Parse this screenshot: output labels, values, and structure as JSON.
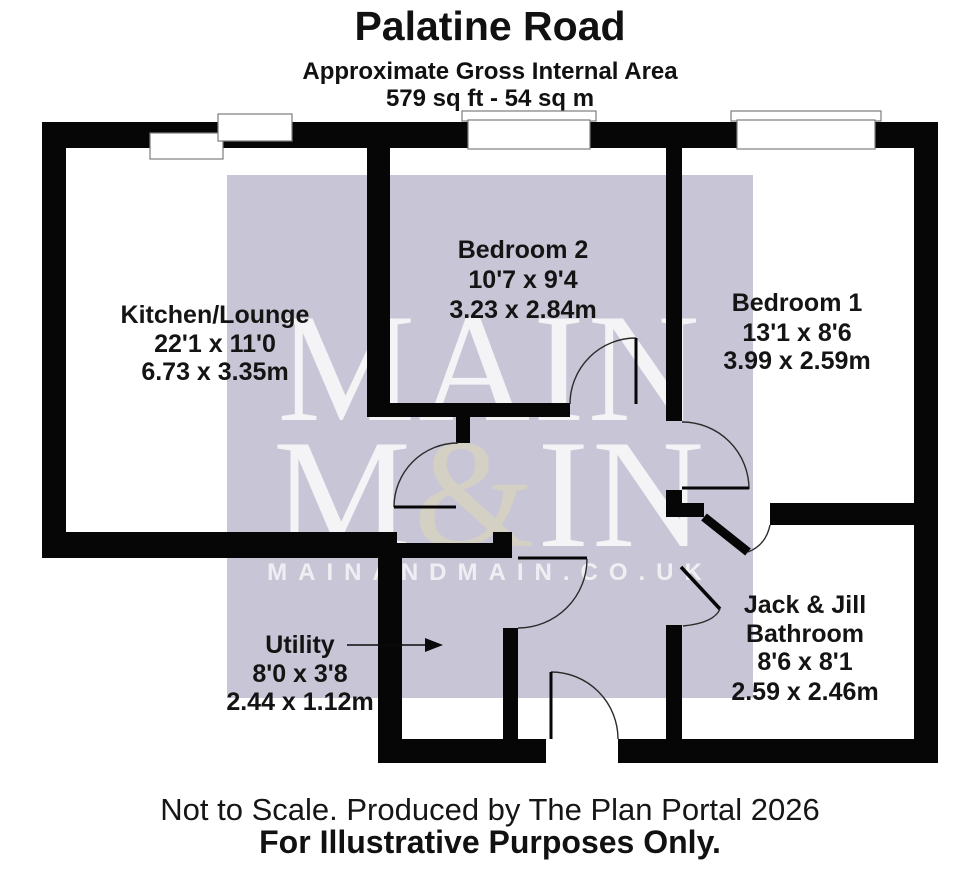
{
  "header": {
    "title": "Palatine Road",
    "subtitle": "Approximate Gross Internal Area",
    "area": "579 sq ft - 54 sq m"
  },
  "rooms": {
    "kitchen_lounge": {
      "name": "Kitchen/Lounge",
      "imperial": "22'1 x 11'0",
      "metric": "6.73 x 3.35m"
    },
    "bedroom2": {
      "name": "Bedroom 2",
      "imperial": "10'7 x 9'4",
      "metric": "3.23 x 2.84m"
    },
    "bedroom1": {
      "name": "Bedroom 1",
      "imperial": "13'1 x 8'6",
      "metric": "3.99 x 2.59m"
    },
    "bathroom": {
      "name_line1": "Jack & Jill",
      "name_line2": "Bathroom",
      "imperial": "8'6 x 8'1",
      "metric": "2.59 x 2.46m"
    },
    "utility": {
      "name": "Utility",
      "imperial": "8'0 x 3'8",
      "metric": "2.44 x 1.12m"
    }
  },
  "watermark": {
    "line1": "MAIN",
    "line2_pre": "M",
    "line2_amp": "&",
    "line2_post": "IN",
    "url": "MAINANDMAIN.CO.UK",
    "bg_color": "#c8c6d6",
    "amp_color": "#d9d4bd"
  },
  "footer": {
    "line1": "Not to Scale. Produced by The Plan Portal 2026",
    "line2": "For Illustrative Purposes Only."
  },
  "colors": {
    "wall": "#060606",
    "page_bg": "#ffffff"
  }
}
